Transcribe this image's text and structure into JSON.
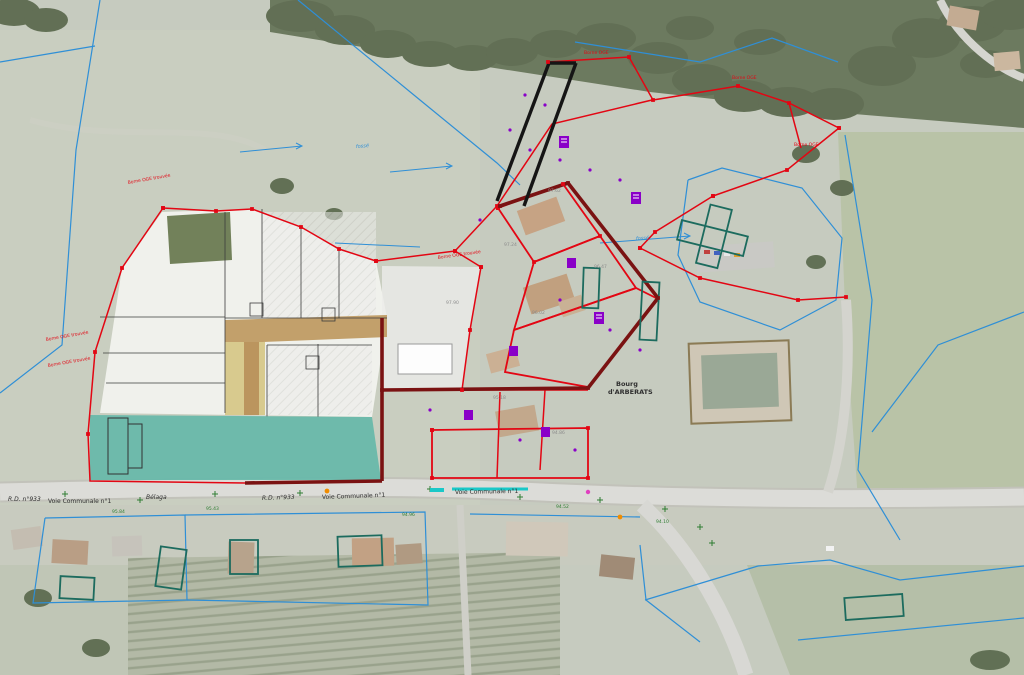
{
  "map": {
    "labels": {
      "bourg_l1": "Bourg",
      "bourg_l2": "d'ARBERATS",
      "rd933_a": "R.D. n°933",
      "rd933_b": "R.D. n°933",
      "vc1_a": "Voie Communale n°1",
      "vc1_b": "Voie Communale n°1",
      "vc1_c": "Voie Communale n°1",
      "belaga": "Bélaga",
      "borne_1": "Borne OGE trouvée",
      "borne_2": "Borne OGE trouvée",
      "borne_3": "Borne OGE trouvée",
      "borne_4": "Borne OGE trouvée",
      "borne_5": "Borne OGE",
      "borne_6": "Borne OGE",
      "borne_7": "Borne OGE",
      "fosse_1": "fossé",
      "fosse_2": "fossé",
      "elev_1": "97.62",
      "elev_2": "97.24",
      "elev_3": "96.47",
      "elev_4": "96.02",
      "elev_5": "95.18",
      "elev_6": "94.86",
      "elev_7": "97.90",
      "road_elev_1": "95.84",
      "road_elev_2": "95.43",
      "road_elev_3": "94.96",
      "road_elev_4": "94.52",
      "road_elev_5": "94.10"
    },
    "features": {
      "project_greenspace": "espace vert",
      "subdivision_lots": "lots",
      "access_road": "voie d'accès",
      "church": "église",
      "cadastral_lines": "limites cadastrales",
      "survey_lines": "polygonale levé",
      "project_boundary": "périmètre du projet"
    }
  },
  "colors": {
    "survey_red": "#e30613",
    "project_maroon": "#7a1212",
    "cadastral_blue": "#2f8fd6",
    "greenspace": "#66b9a9",
    "road_fill": "#c2a06b",
    "khaki": "#d8ca8e",
    "olive": "#72815a",
    "lot_white": "#f3f3ef",
    "utility_purple": "#8a00c8",
    "tick_green": "#2e7d32",
    "cyan_mark": "#1ac8c8",
    "black_line": "#151515"
  }
}
